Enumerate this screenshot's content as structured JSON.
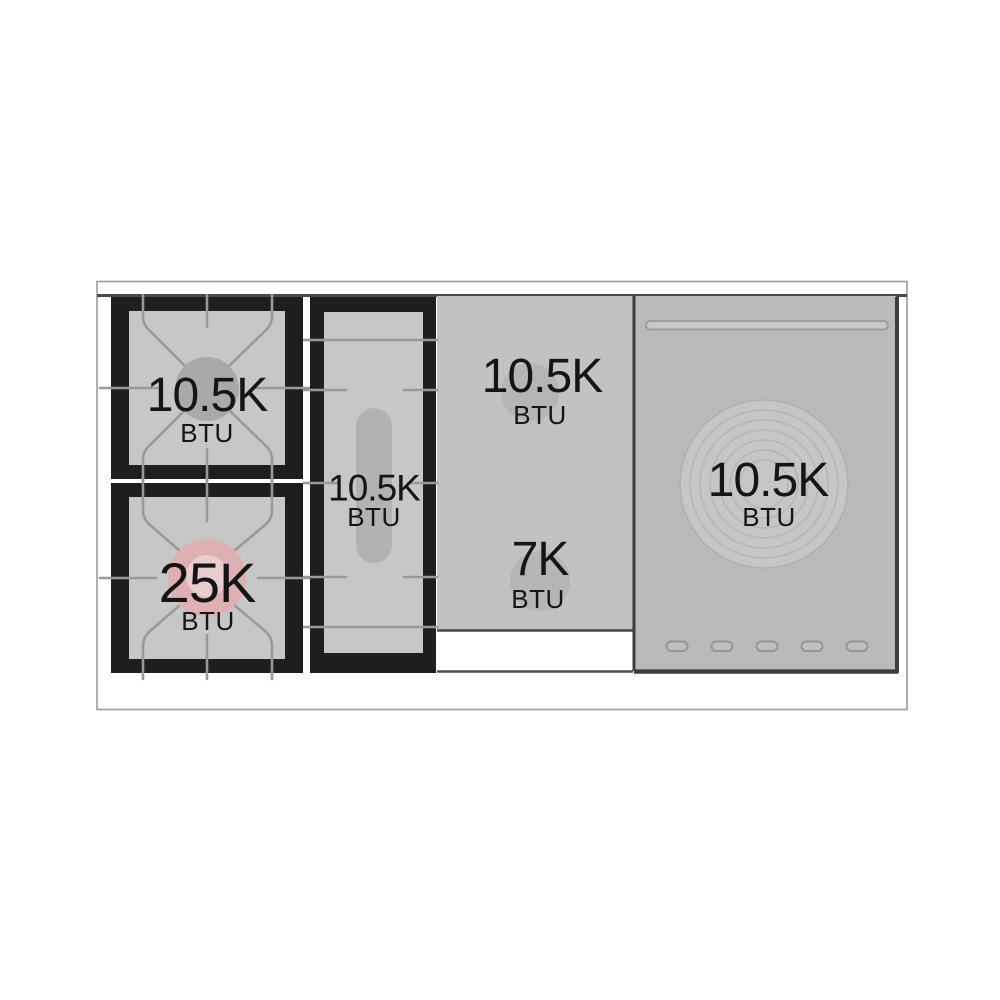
{
  "diagram": {
    "title": "Range cooktop burner BTU specification diagram",
    "burners": [
      {
        "id": "left-rear-burner",
        "power": "10.5K",
        "unit": "BTU"
      },
      {
        "id": "left-front-burner",
        "power": "25K",
        "unit": "BTU"
      },
      {
        "id": "center-oval-burner",
        "power": "10.5K",
        "unit": "BTU"
      },
      {
        "id": "griddle-rear-burner",
        "power": "10.5K",
        "unit": "BTU"
      },
      {
        "id": "griddle-front-burner",
        "power": "7K",
        "unit": "BTU"
      },
      {
        "id": "right-plate-burner",
        "power": "10.5K",
        "unit": "BTU"
      }
    ],
    "colors": {
      "background": "#ffffff",
      "frame_outline": "#9b9b9b",
      "grate_black": "#1e1e1e",
      "surface_gray": "#c7c7c7",
      "griddle_gray": "#c2c2c2",
      "panel_gray": "#bababa",
      "grate_line_gray": "#999999",
      "burner_gray": "#a9a9a9",
      "accent_pink": "#deafb3",
      "accent_pink_light": "#e9cccd",
      "edge_dark": "#464646",
      "text": "#151515"
    }
  }
}
